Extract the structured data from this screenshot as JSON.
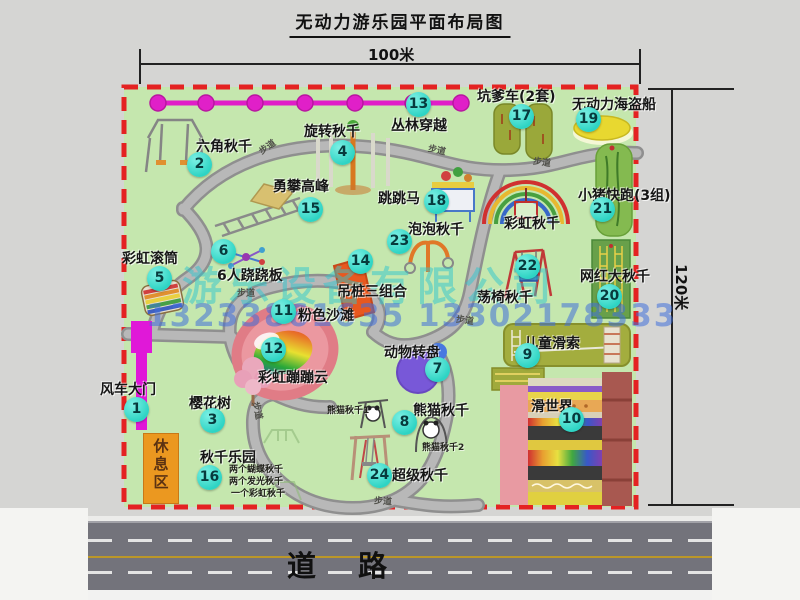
{
  "title": "无动力游乐园平面布局图",
  "dims": {
    "top": "100米",
    "right": "120米"
  },
  "road_label": "道路",
  "rest_area": "休息区",
  "walkway_label": "步道",
  "watermark": {
    "company": "游乐设备有限公司",
    "phone": "13233861635 13302178333"
  },
  "colors": {
    "park_green": "#c5e7ae",
    "border_red": "#e42222",
    "badge_cyan": "#2ed4c4",
    "gate_magenta": "#e018d8",
    "chain_magenta": "#e01ec8",
    "rest_orange": "#eb9820",
    "road_gray": "#73737b",
    "road_line_yellow": "#bb9728"
  },
  "attractions": [
    {
      "num": "1",
      "label": "风车大门",
      "lx": 100,
      "ly": 379,
      "bx": 137,
      "by": 410
    },
    {
      "num": "2",
      "label": "六角秋千",
      "lx": 196,
      "ly": 136,
      "bx": 200,
      "by": 165
    },
    {
      "num": "3",
      "label": "樱花树",
      "lx": 189,
      "ly": 393,
      "bx": 213,
      "by": 421
    },
    {
      "num": "4",
      "label": "旋转秋千",
      "lx": 304,
      "ly": 121,
      "bx": 343,
      "by": 153
    },
    {
      "num": "5",
      "label": "彩虹滚筒",
      "lx": 122,
      "ly": 248,
      "bx": 160,
      "by": 279
    },
    {
      "num": "6",
      "label": "6人跷跷板",
      "lx": 217,
      "ly": 265,
      "bx": 224,
      "by": 252
    },
    {
      "num": "7",
      "label": "动物转盘",
      "lx": 384,
      "ly": 342,
      "bx": 438,
      "by": 370
    },
    {
      "num": "8",
      "label": "熊猫秋千",
      "lx": 413,
      "ly": 400,
      "bx": 405,
      "by": 423
    },
    {
      "num": "9",
      "label": "儿童滑索",
      "lx": 524,
      "ly": 333,
      "bx": 528,
      "by": 356
    },
    {
      "num": "10",
      "label": "滑世界",
      "lx": 531,
      "ly": 396,
      "bx": 572,
      "by": 420
    },
    {
      "num": "11",
      "label": "粉色沙滩",
      "lx": 298,
      "ly": 305,
      "bx": 284,
      "by": 312
    },
    {
      "num": "12",
      "label": "彩虹蹦蹦云",
      "lx": 258,
      "ly": 367,
      "bx": 274,
      "by": 350
    },
    {
      "num": "13",
      "label": "丛林穿越",
      "lx": 391,
      "ly": 115,
      "bx": 419,
      "by": 105
    },
    {
      "num": "14",
      "label": "吊桩三组合",
      "lx": 337,
      "ly": 281,
      "bx": 361,
      "by": 262
    },
    {
      "num": "15",
      "label": "勇攀高峰",
      "lx": 273,
      "ly": 176,
      "bx": 311,
      "by": 210
    },
    {
      "num": "16",
      "label": "秋千乐园",
      "lx": 200,
      "ly": 447,
      "bx": 210,
      "by": 478
    },
    {
      "num": "17",
      "label": "坑爹车(2套)",
      "lx": 477,
      "ly": 86,
      "bx": 522,
      "by": 117
    },
    {
      "num": "18",
      "label": "跳跳马",
      "lx": 378,
      "ly": 188,
      "bx": 437,
      "by": 202
    },
    {
      "num": "19",
      "label": "无动力海盗船",
      "lx": 572,
      "ly": 94,
      "bx": 589,
      "by": 120
    },
    {
      "num": "20",
      "label": "网红大秋千",
      "lx": 580,
      "ly": 266,
      "bx": 610,
      "by": 297
    },
    {
      "num": "21",
      "label": "小猪快跑(3组)",
      "lx": 578,
      "ly": 185,
      "bx": 603,
      "by": 210
    },
    {
      "num": "22",
      "label": "荡椅秋千",
      "lx": 477,
      "ly": 287,
      "bx": 528,
      "by": 267
    },
    {
      "num": "23",
      "label": "泡泡秋千",
      "lx": 408,
      "ly": 219,
      "bx": 400,
      "by": 242
    },
    {
      "num": "24",
      "label": "超级秋千",
      "lx": 392,
      "ly": 465,
      "bx": 380,
      "by": 476
    }
  ],
  "extra_labels": [
    {
      "text": "彩虹秋千",
      "x": 504,
      "y": 213
    }
  ],
  "sub_labels": [
    {
      "text": "熊猫秋千1",
      "x": 327,
      "y": 403
    },
    {
      "text": "熊猫秋千2",
      "x": 422,
      "y": 440
    },
    {
      "text": "两个蝴蝶秋千",
      "x": 229,
      "y": 462
    },
    {
      "text": "两个发光秋千",
      "x": 229,
      "y": 474
    },
    {
      "text": "一个彩虹秋千",
      "x": 231,
      "y": 486
    }
  ],
  "walkway_markers": [
    {
      "x": 258,
      "y": 140,
      "rot": -35
    },
    {
      "x": 428,
      "y": 143,
      "rot": 12
    },
    {
      "x": 533,
      "y": 155,
      "rot": 8
    },
    {
      "x": 237,
      "y": 286,
      "rot": 0
    },
    {
      "x": 456,
      "y": 313,
      "rot": 8
    },
    {
      "x": 249,
      "y": 404,
      "rot": 78
    },
    {
      "x": 374,
      "y": 494,
      "rot": 4
    }
  ]
}
